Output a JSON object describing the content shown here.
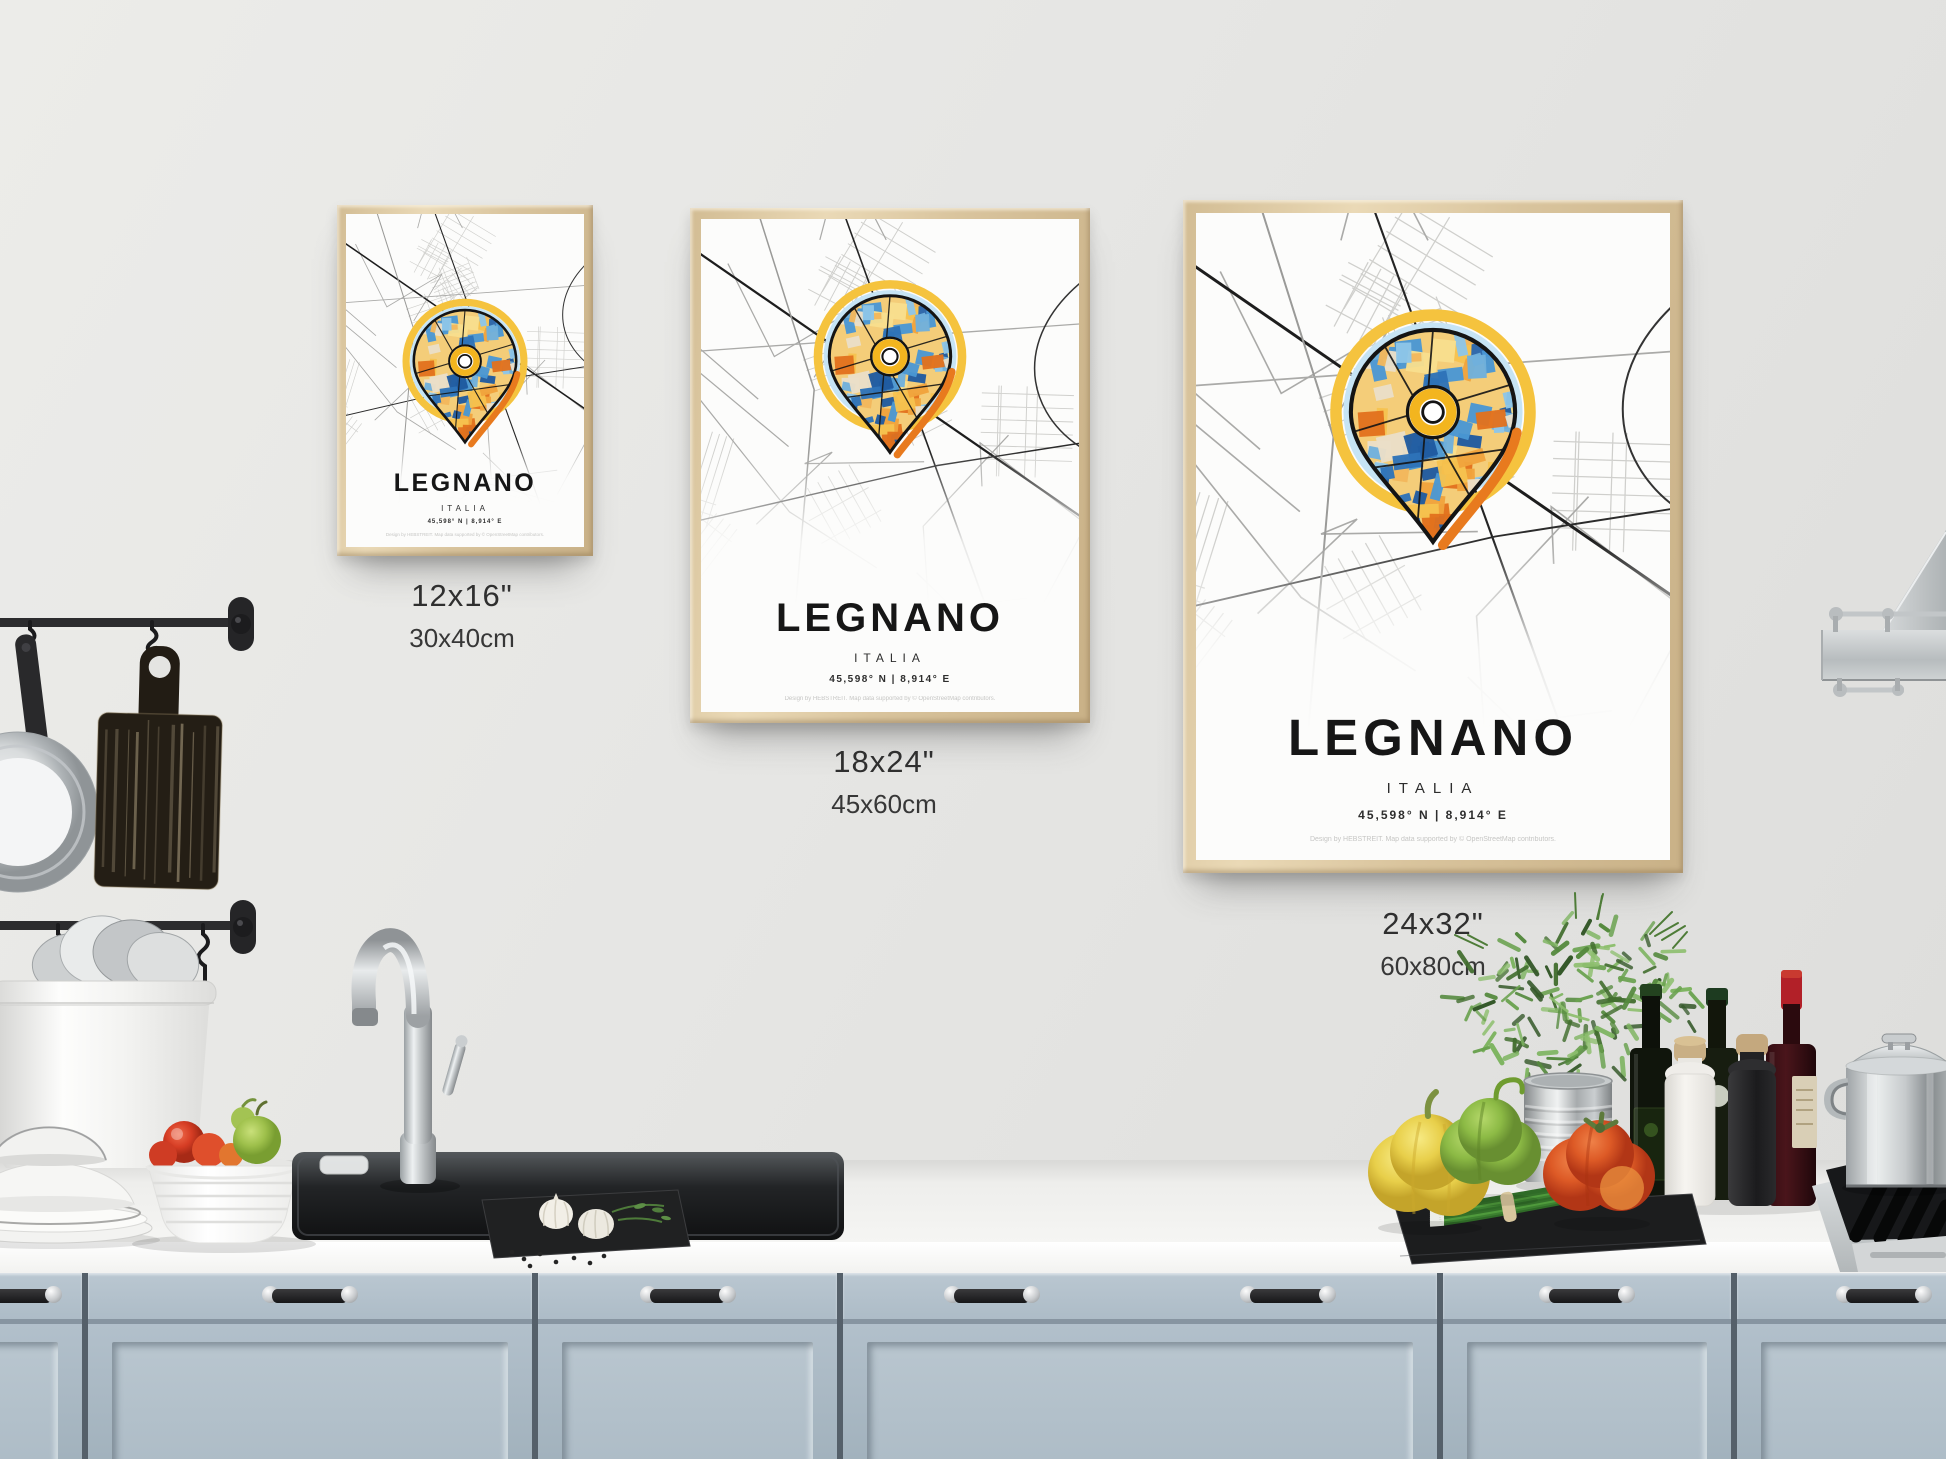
{
  "poster": {
    "city": "LEGNANO",
    "country": "ITALIA",
    "coordinates": "45,598° N | 8,914° E",
    "credit": "Design by HEBSTREIT. Map data supported by © OpenStreetMap contributors.",
    "style": {
      "pin_blue": "#2e73b8",
      "pin_light_blue": "#c6e4f5",
      "pin_yellow": "#f5c33e",
      "pin_orange": "#e87a1e",
      "frame_wood": "#dcc69e",
      "paper": "#fbfbf9"
    }
  },
  "size_labels": [
    {
      "inches": "12x16\"",
      "cm": "30x40cm"
    },
    {
      "inches": "18x24\"",
      "cm": "45x60cm"
    },
    {
      "inches": "24x32\"",
      "cm": "60x80cm"
    }
  ],
  "scene": {
    "wall_color": "#e6e6e4",
    "cabinet_color": "#adbbc6",
    "counter_color": "#f6f6f4",
    "items": [
      "utensil-rail",
      "s-hooks",
      "hanging-pan",
      "hanging-cutting-board",
      "utensil-bucket-with-plates",
      "plate-stack",
      "vegetable-bowl",
      "kitchen-faucet",
      "sink",
      "soap-dish",
      "garlic-slate-board",
      "peppercorns",
      "yellow-bell-pepper",
      "green-bell-pepper",
      "red-bell-pepper",
      "herb-plant-in-tin-can",
      "olive-oil-bottles",
      "salt-grinder",
      "pepper-grinder",
      "wine-bottle",
      "scallions-on-slate",
      "stock-pot",
      "gas-hob",
      "range-hood",
      "kitchen-cabinets"
    ]
  }
}
